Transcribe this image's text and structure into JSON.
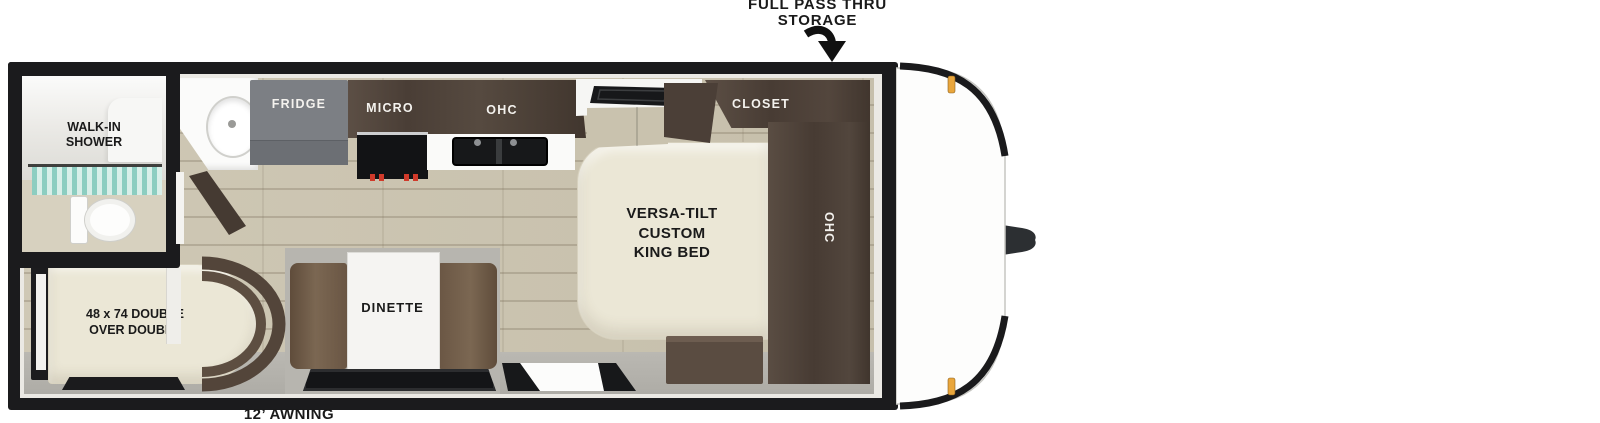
{
  "callouts": {
    "pass_thru": "FULL PASS THRU\nSTORAGE",
    "awning": "12’ AWNING"
  },
  "labels": {
    "shower": "WALK-IN\nSHOWER",
    "fridge": "FRIDGE",
    "micro": "MICRO",
    "kitchen_ohc": "OHC",
    "closet": "CLOSET",
    "bedroom_ohc": "OHC",
    "bed": "VERSA-TILT\nCUSTOM\nKING BED",
    "dinette": "DINETTE",
    "bunk": "48 x 74 DOUBLE\nOVER DOUBLE"
  },
  "colors": {
    "wall": "#1b1b1d",
    "cabinet_dark": "#4e423b",
    "bench_brown": "#73604c",
    "mattress_cream": "#ebe7d6",
    "floor_wood": "#cbc4b0",
    "floor_gray": "#b4b2ac",
    "fridge_gray": "#7c7f84",
    "curtain_teal": "#86cdc0",
    "marker_amber": "#e9a63c",
    "knob_red": "#d03a2a"
  }
}
